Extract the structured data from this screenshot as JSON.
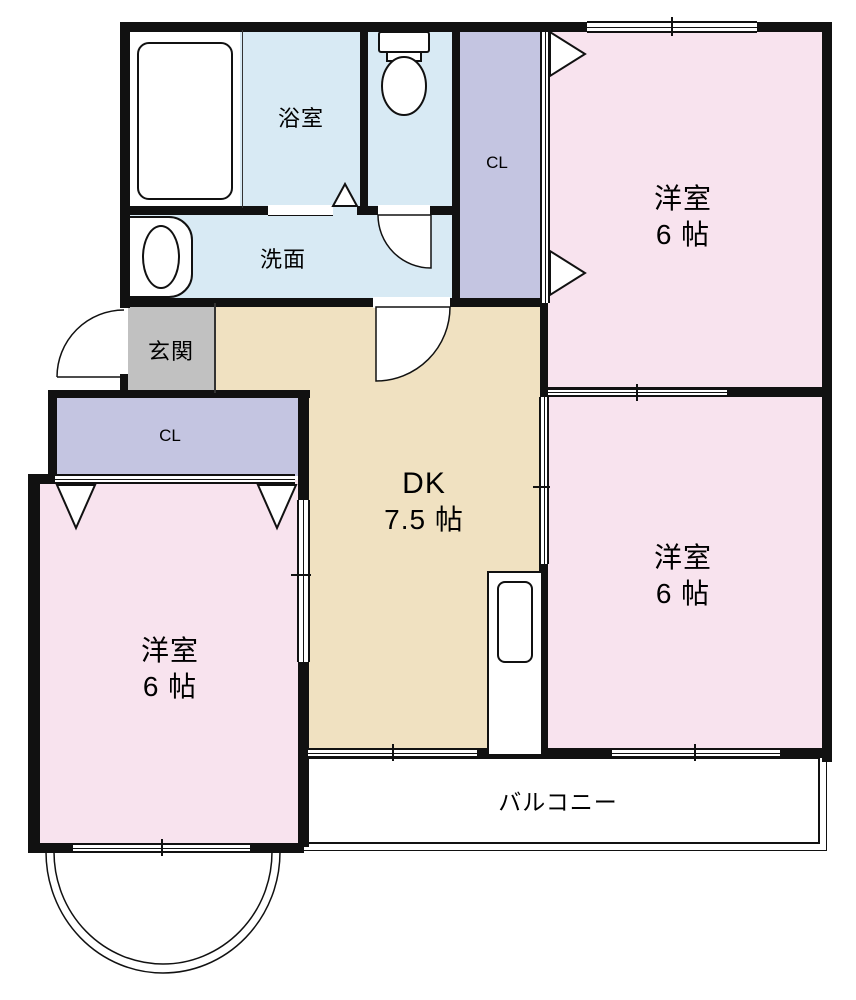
{
  "plan": {
    "type": "apartment-floor-plan",
    "rooms": {
      "bathroom": {
        "label": "浴室"
      },
      "washroom": {
        "label": "洗面"
      },
      "closet_hall": {
        "label": "CL"
      },
      "entrance": {
        "label": "玄関"
      },
      "closet_bedroom_left": {
        "label": "CL"
      },
      "dining_kitchen": {
        "label": "DK",
        "size": "7.5 帖"
      },
      "bedroom_top_right": {
        "label": "洋室",
        "size": "6 帖"
      },
      "bedroom_bottom_right": {
        "label": "洋室",
        "size": "6 帖"
      },
      "bedroom_bottom_left": {
        "label": "洋室",
        "size": "6 帖"
      },
      "balcony": {
        "label": "バルコニー"
      }
    },
    "colors": {
      "wall": "#111111",
      "line": "#333333",
      "water": "#d8eaf4",
      "closet": "#c4c5e1",
      "bedroom": "#f8e3ee",
      "dk": "#f0e1c1",
      "entrance": "#c1c1c1"
    }
  }
}
